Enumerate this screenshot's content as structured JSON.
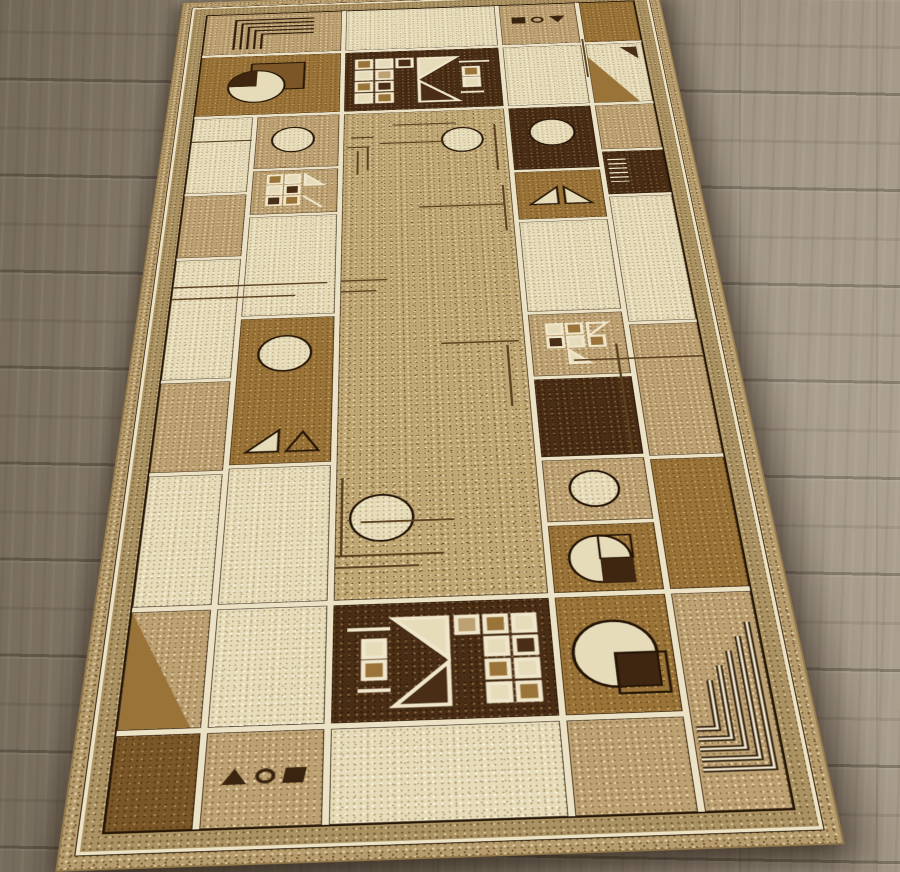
{
  "meta": {
    "title": "Beige geometric area rug on a wood plank floor",
    "image_type": "photograph",
    "text_content": "none (no readable text in image)"
  },
  "scene": {
    "floor": {
      "material": "wood laminate planks",
      "plank_orientation": "horizontal",
      "lighting": "darker at upper left, brighter at right"
    },
    "rug": {
      "style": "Arts and Crafts / Mission geometric",
      "orientation": "rectangular, photographed in perspective, top edge farther away",
      "border": "grid of cream, tan, gold and dark-brown blocks separated by cream lines with black edging",
      "center": "large speckled tan field with thin brown accent lines and two cream circles",
      "motifs": [
        "greek-key nested corner lines (top-left dark, bottom-right cream)",
        "squares cluster with white grid and triangles (top and bottom bands)",
        "circle with quarter-pie wedge",
        "cream circles",
        "diagonal triangle blocks",
        "glyph row square-circle-triangle"
      ],
      "glyphs_top": "filled square, circle outline, filled down triangle",
      "glyphs_bottom": "filled up triangle, circle outline, filled square"
    }
  },
  "palette": {
    "floor_dark": "#7b705f",
    "floor_mid": "#978b7a",
    "floor_light": "#a89c8b",
    "bind": "#b79d6e",
    "margin": "#ab9263",
    "line_cream": "#ece3c6",
    "cream": "#e6dcba",
    "tan": "#bda173",
    "gold": "#9a7338",
    "brown": "#7a5629",
    "dark": "#492d15",
    "field": "#bfa673",
    "accent": "#5c4120"
  }
}
